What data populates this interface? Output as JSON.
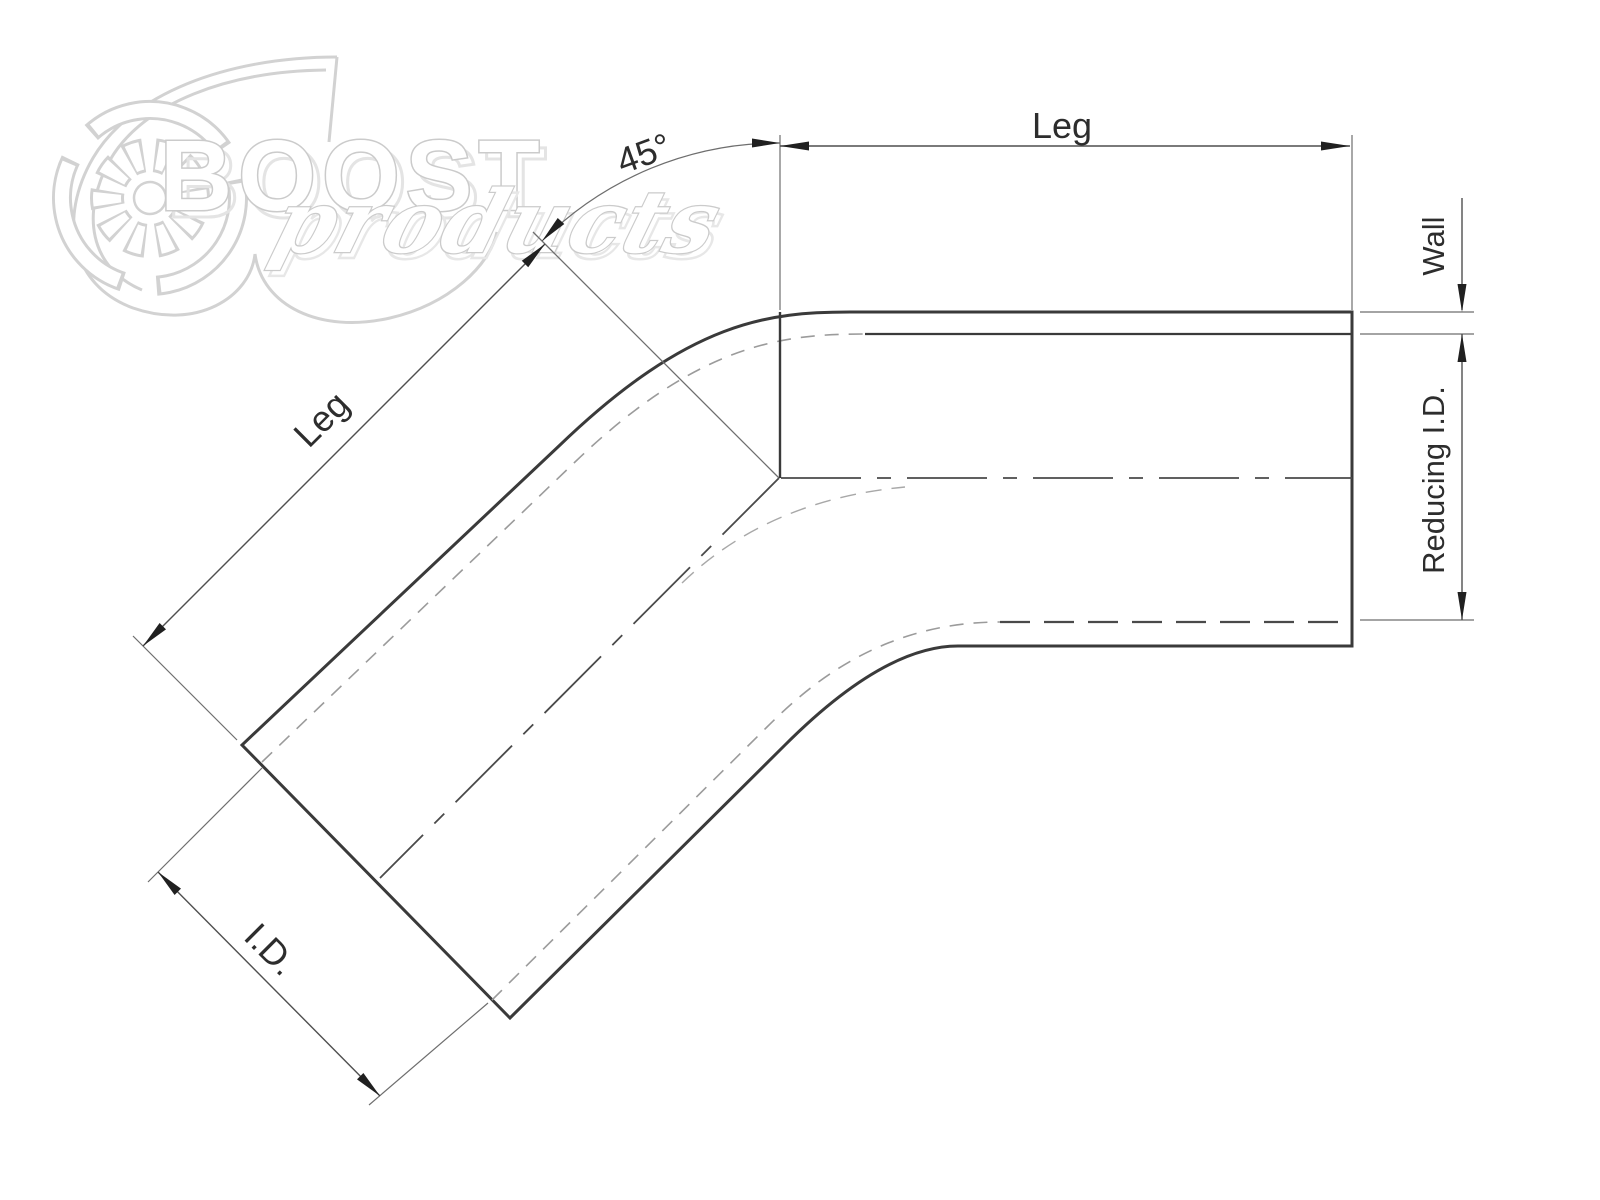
{
  "watermark": {
    "brand_top": "BOOST",
    "brand_bottom": "products"
  },
  "labels": {
    "leg_top": "Leg",
    "leg_diagonal": "Leg",
    "angle": "45°",
    "wall": "Wall",
    "reducing_id": "Reducing I.D.",
    "inner_diameter": "I.D."
  },
  "colors": {
    "background": "#ffffff",
    "drawing_line": "#3a3a3a",
    "dimension_line": "#4f4f4f",
    "hidden_line": "#9b9b9b",
    "centerline": "#4a4a4a",
    "watermark": "#d2d2d2",
    "text": "#2d2d2d"
  },
  "drawing": {
    "type": "technical-diagram",
    "subject": "45-degree reducing silicone elbow hose, dimensioned section drawing",
    "dimensions_shown": [
      "Leg (horizontal section)",
      "Leg (diagonal section)",
      "45° bend angle",
      "Wall thickness",
      "Reducing I.D.",
      "I.D."
    ]
  }
}
